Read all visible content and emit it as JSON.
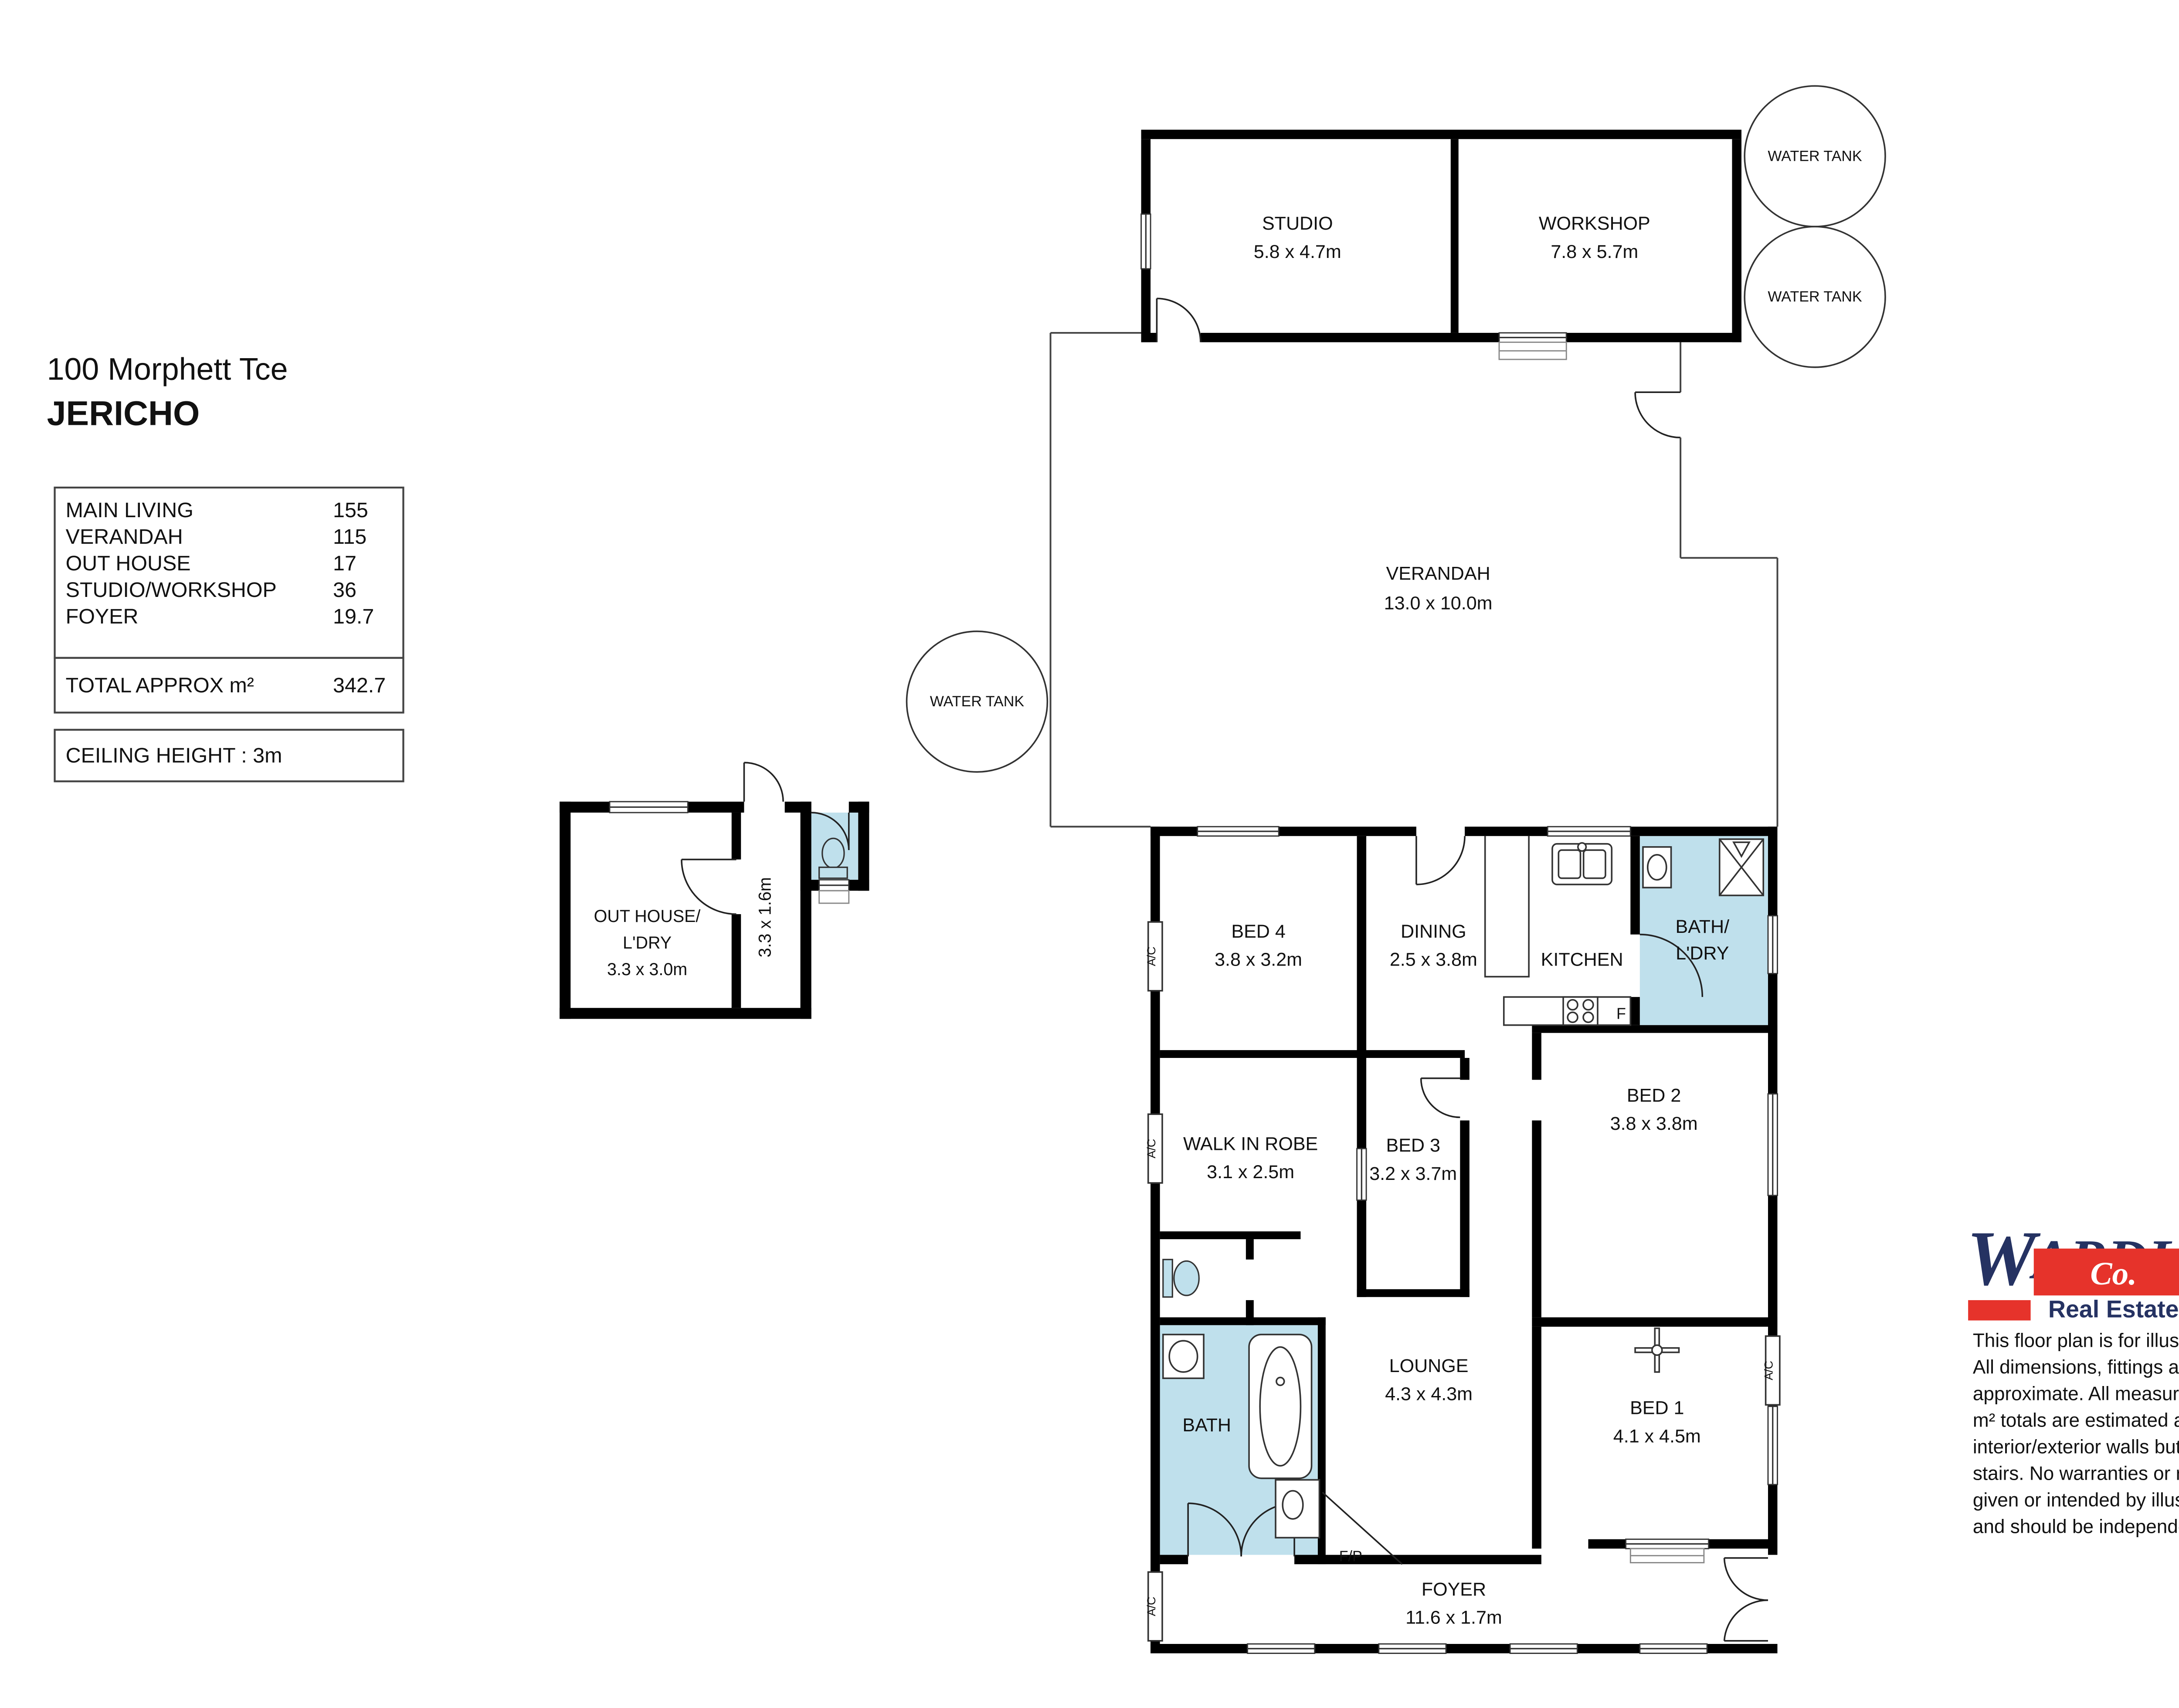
{
  "header": {
    "address": "100 Morphett Tce",
    "suburb": "JERICHO"
  },
  "area_table": {
    "rows": [
      {
        "label": "MAIN LIVING",
        "value": "155"
      },
      {
        "label": "VERANDAH",
        "value": "115"
      },
      {
        "label": "OUT HOUSE",
        "value": "17"
      },
      {
        "label": "STUDIO/WORKSHOP",
        "value": "36"
      },
      {
        "label": "FOYER",
        "value": "19.7"
      }
    ],
    "total_label": "TOTAL APPROX m²",
    "total_value": "342.7",
    "ceiling_note": "CEILING HEIGHT : 3m"
  },
  "plan": {
    "colors": {
      "wet_area": "#bfe0ec"
    },
    "studio": {
      "name": "STUDIO",
      "dims": "5.8 x 4.7m"
    },
    "workshop": {
      "name": "WORKSHOP",
      "dims": "7.8 x 5.7m"
    },
    "water_tank_label": "WATER TANK",
    "verandah": {
      "name": "VERANDAH",
      "dims": "13.0 x 10.0m"
    },
    "outhouse": {
      "line1": "OUT HOUSE/",
      "line2": "L'DRY",
      "dims": "3.3 x 3.0m",
      "corridor_dims": "3.3 x 1.6m"
    },
    "bed4": {
      "name": "BED 4",
      "dims": "3.8 x 3.2m"
    },
    "dining": {
      "name": "DINING",
      "dims": "2.5 x 3.8m"
    },
    "kitchen": {
      "name": "KITCHEN"
    },
    "bath_ldry": {
      "line1": "BATH/",
      "line2": "L'DRY"
    },
    "walk_in_robe": {
      "name": "WALK IN ROBE",
      "dims": "3.1 x 2.5m"
    },
    "bed3": {
      "name": "BED 3",
      "dims": "3.2 x 3.7m"
    },
    "bed2": {
      "name": "BED 2",
      "dims": "3.8 x 3.8m"
    },
    "lounge": {
      "name": "LOUNGE",
      "dims": "4.3 x 4.3m"
    },
    "bed1": {
      "name": "BED 1",
      "dims": "4.1 x 4.5m"
    },
    "bath": {
      "name": "BATH"
    },
    "foyer": {
      "name": "FOYER",
      "dims": "11.6 x 1.7m"
    },
    "fireplace_label": "F/P",
    "fridge_label": "F",
    "ac_label": "A/C"
  },
  "branding": {
    "name_w": "W",
    "name_mid": "ARDL",
    "name_e": "E",
    "co": "Co.",
    "tagline": "Real Estate",
    "navy": "#253262",
    "red": "#e6332b"
  },
  "disclaimer": {
    "lines": [
      "This floor plan is for illustrative purposes only.",
      "All dimensions, fittings and fixtures are",
      "approximate. All measurements are in metres,",
      "m² totals are estimated and include",
      "interior/exterior walls but not eaves or external",
      "stairs. No warranties or representations are",
      "given or intended by illustrator, agent or vendor",
      "and should be independently verified."
    ]
  }
}
